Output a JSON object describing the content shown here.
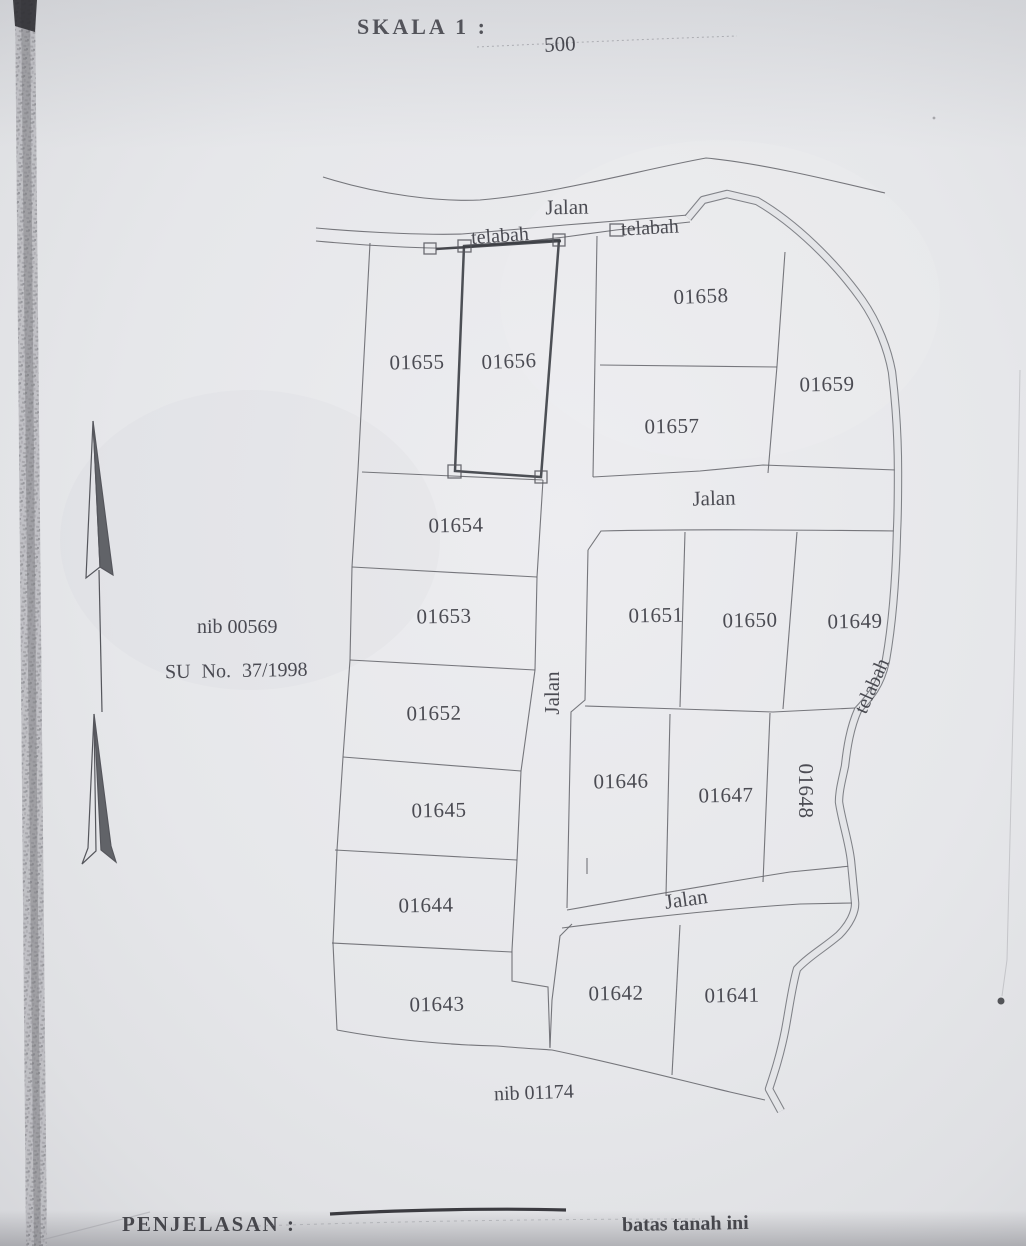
{
  "header": {
    "scale_label": "SKALA 1 :",
    "scale_value": "500"
  },
  "map": {
    "road_label": "Jalan",
    "waterway_label": "telabah",
    "nib_upper": "nib 00569",
    "survey_ref": "SU No. 37/1998",
    "nib_lower": "nib 01174",
    "parcels": {
      "p01641": "01641",
      "p01642": "01642",
      "p01643": "01643",
      "p01644": "01644",
      "p01645": "01645",
      "p01646": "01646",
      "p01647": "01647",
      "p01648": "01648",
      "p01649": "01649",
      "p01650": "01650",
      "p01651": "01651",
      "p01652": "01652",
      "p01653": "01653",
      "p01654": "01654",
      "p01655": "01655",
      "p01656": "01656",
      "p01657": "01657",
      "p01658": "01658",
      "p01659": "01659"
    }
  },
  "legend": {
    "label": "PENJELASAN :",
    "boundary_note": "batas tanah ini"
  }
}
